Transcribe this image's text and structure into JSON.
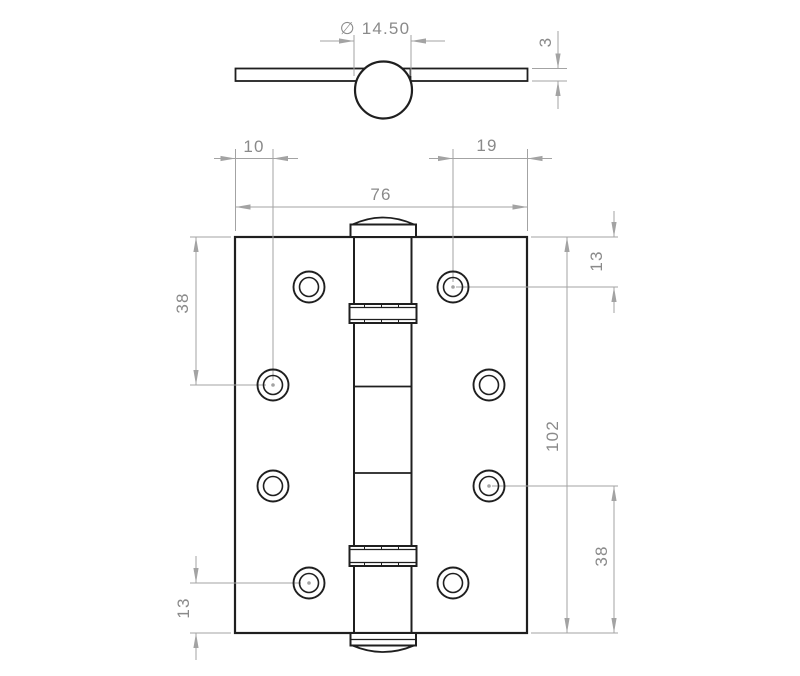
{
  "drawing_type": "hinge-technical-drawing",
  "colors": {
    "geometry": "#1f1f1f",
    "dimension_lines": "#a3a3a3",
    "dimension_text": "#8a8a8a",
    "background": "#ffffff"
  },
  "dimensions": {
    "knuckle_diameter": {
      "label": "∅ 14.50"
    },
    "leaf_thickness": {
      "label": "3"
    },
    "hole_offset_left": {
      "label": "10"
    },
    "hole_offset_right": {
      "label": "19"
    },
    "overall_width": {
      "label": "76"
    },
    "top_edge_to_second_hole_left": {
      "label": "38"
    },
    "bottom_hole_to_edge_left": {
      "label": "13"
    },
    "top_edge_to_first_hole_right": {
      "label": "13"
    },
    "overall_height": {
      "label": "102"
    },
    "third_hole_to_bottom_edge_right": {
      "label": "38"
    }
  }
}
